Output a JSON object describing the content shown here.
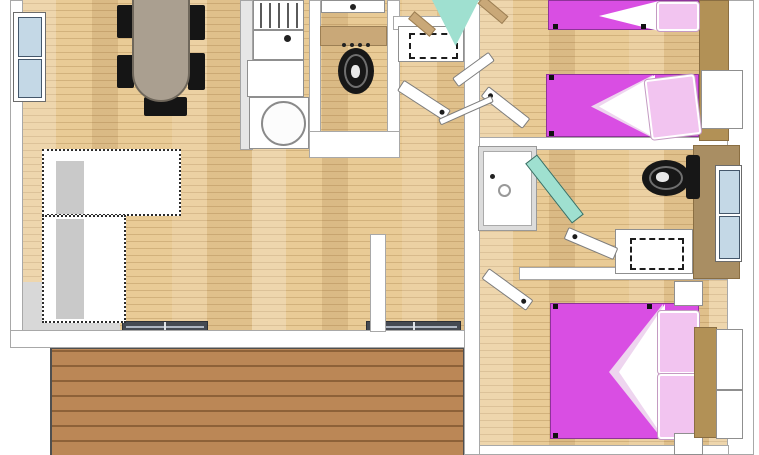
{
  "scene": {
    "type": "floor-plan",
    "view": "top-down-3d",
    "rooms": [
      "living-dining-kitchen",
      "wc",
      "hallway",
      "twin-bedroom",
      "shower-bathroom",
      "master-bedroom",
      "deck-terrace"
    ],
    "furniture": {
      "living_dining": [
        "oval-dining-table",
        "dining-chairs-x5",
        "l-shaped-sofa",
        "door-mat-x2",
        "entry-step"
      ],
      "kitchen": [
        "hob-unit",
        "sink-unit",
        "counter",
        "corner-appliance"
      ],
      "wc": [
        "washbasin",
        "black-toilet",
        "cistern-shelf"
      ],
      "hallway": [
        "storage-cabinet",
        "glass-entry-door",
        "interior-doors-x2"
      ],
      "twin_bedroom": [
        "single-bed-x2",
        "wardrobe",
        "overhead-cabinet",
        "interior-door"
      ],
      "bathroom": [
        "shower-tray",
        "teal-glass-door",
        "black-toilet",
        "vanity-unit",
        "window",
        "interior-door"
      ],
      "master_bedroom": [
        "double-bed",
        "nightstand-x2",
        "wardrobe",
        "wardrobe-panels",
        "interior-door"
      ],
      "exterior": [
        "wood-deck",
        "left-window"
      ]
    }
  },
  "colors": {
    "floor_base": "#e9cb96",
    "deck": "#bb8756",
    "deck_line": "#8d6138",
    "wall": "#ffffff",
    "wall_border": "#a8a8a8",
    "bed": "#d94ee3",
    "pillow": "#f2c4f0",
    "fold_shade": "#eed5ef",
    "glass": "#9fe0d0",
    "window_glass": "#c4d8e6",
    "brown": "#b29156",
    "brown_dark": "#8a6e42",
    "tan": "#c9a878",
    "toilet": "#171717",
    "table": "#aa9f90",
    "sofa": "#ffffff",
    "sofa_shadow": "#c9c9c9",
    "mat": "#454a52",
    "gray_floor": "#d8d8d8"
  }
}
